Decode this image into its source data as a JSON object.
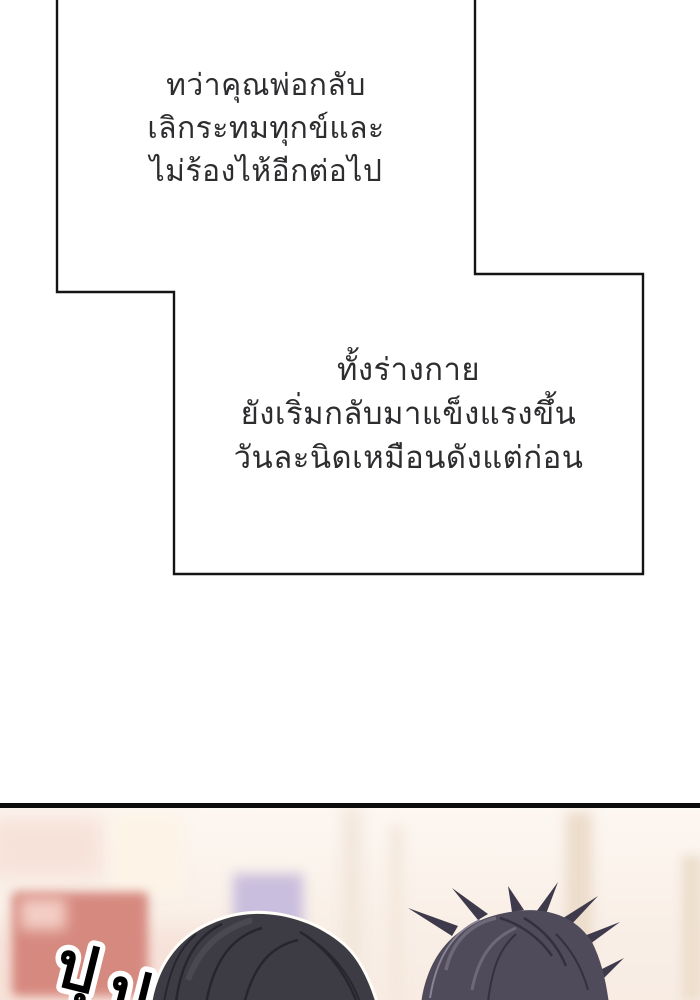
{
  "page": {
    "width": 700,
    "height": 1000,
    "background": "#ffffff"
  },
  "narration_panel_top": {
    "lines": [
      "ทว่าคุณพ่อกลับ",
      "เลิกระทมทุกข์และ",
      "ไม่ร้องไห้อีกต่อไป"
    ]
  },
  "narration_panel_bottom": {
    "lines": [
      "ทั้งร่างกาย",
      "ยังเริ่มกลับมาแข็งแรงขึ้น",
      "วันละนิดเหมือนดังแต่ก่อน"
    ]
  },
  "sound_effect": {
    "full_text": "ปุปุ",
    "text_parts": [
      "ปุ",
      "ปุ"
    ]
  },
  "colors": {
    "panel_border": "#141414",
    "narration_text": "#2d2d30",
    "divider": "#0c0c0c",
    "wall_background": "#f9efe7",
    "red_picture_frame": "#d6897f",
    "lavender_picture_frame": "#c9bedd",
    "hair_left_person": "#3d3c45",
    "hair_right_person": "#4f4b5a",
    "sfx_fill": "#000000",
    "sfx_outline": "#ffffff"
  }
}
